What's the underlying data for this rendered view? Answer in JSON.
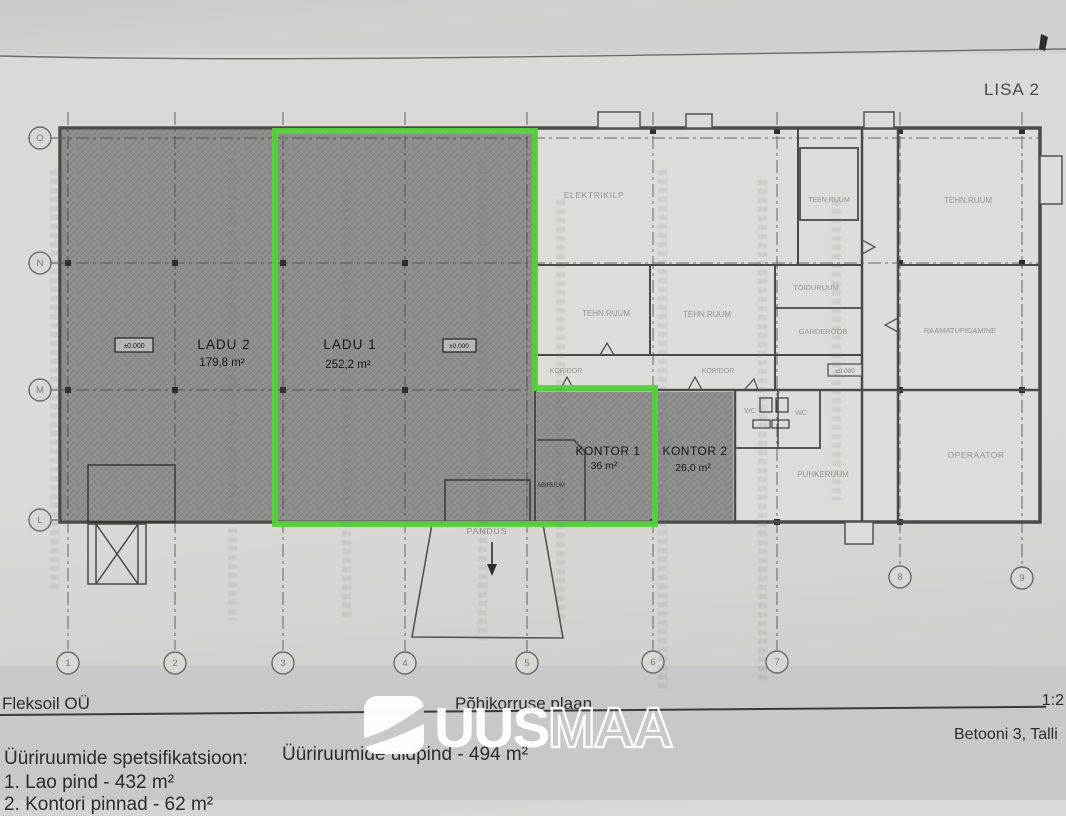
{
  "page": {
    "attachment_label": "LISA 2"
  },
  "plan": {
    "rooms": {
      "ladu2": {
        "name": "LADU 2",
        "area": "179,8 m²"
      },
      "ladu1": {
        "name": "LADU 1",
        "area": "252,2 m²"
      },
      "kontor1": {
        "name": "KONTOR 1",
        "area": "36 m²"
      },
      "kontor2": {
        "name": "KONTOR 2",
        "area": "26,0 m²"
      },
      "elektrikilp": "ELEKTRIKILP",
      "teen_ruum": "TEEN.RUUM",
      "tehn_ruum_a": "TEHN.RUUM",
      "tehn_ruum_b": "TEHN.RUUM",
      "tehn_ruum_c": "TEHN.RUUM",
      "toiduruum": "TOIDURUUM",
      "garderoob": "GARDEROOB",
      "raamatupidamine": "RAAMATUPIDAMINE",
      "koridor_a": "KORIDOR",
      "koridor_b": "KORIDOR",
      "wc_a": "WC",
      "wc_b": "WC",
      "puhkeruum": "PUHKERUUM",
      "operaator": "OPERAATOR",
      "abiruum": "ABIRUUM",
      "pandus": "PANDUS"
    },
    "elevation_marks": [
      "±0.000",
      "±0.000",
      "±0.000"
    ],
    "grid": {
      "rows": [
        "O",
        "N",
        "M",
        "L"
      ],
      "cols": [
        "1",
        "2",
        "3",
        "4",
        "5",
        "6",
        "7",
        "8",
        "9"
      ]
    },
    "highlight_color": "#55d13c"
  },
  "footer": {
    "company": "Fleksoil OÜ",
    "drawing_title": "Põhikorruse plaan",
    "scale": "1:2",
    "address": "Betooni 3, Talli",
    "spec_heading": "Üüriruumide spetsifikatsioon:",
    "spec_item_1": "1. Lao pind - 432 m²",
    "spec_item_2": "2. Kontori pinnad - 62 m²",
    "total_area": "Üüriruumide üldpind - 494 m²"
  },
  "logo": {
    "part_bold": "UUS",
    "part_outline": "MAA"
  }
}
